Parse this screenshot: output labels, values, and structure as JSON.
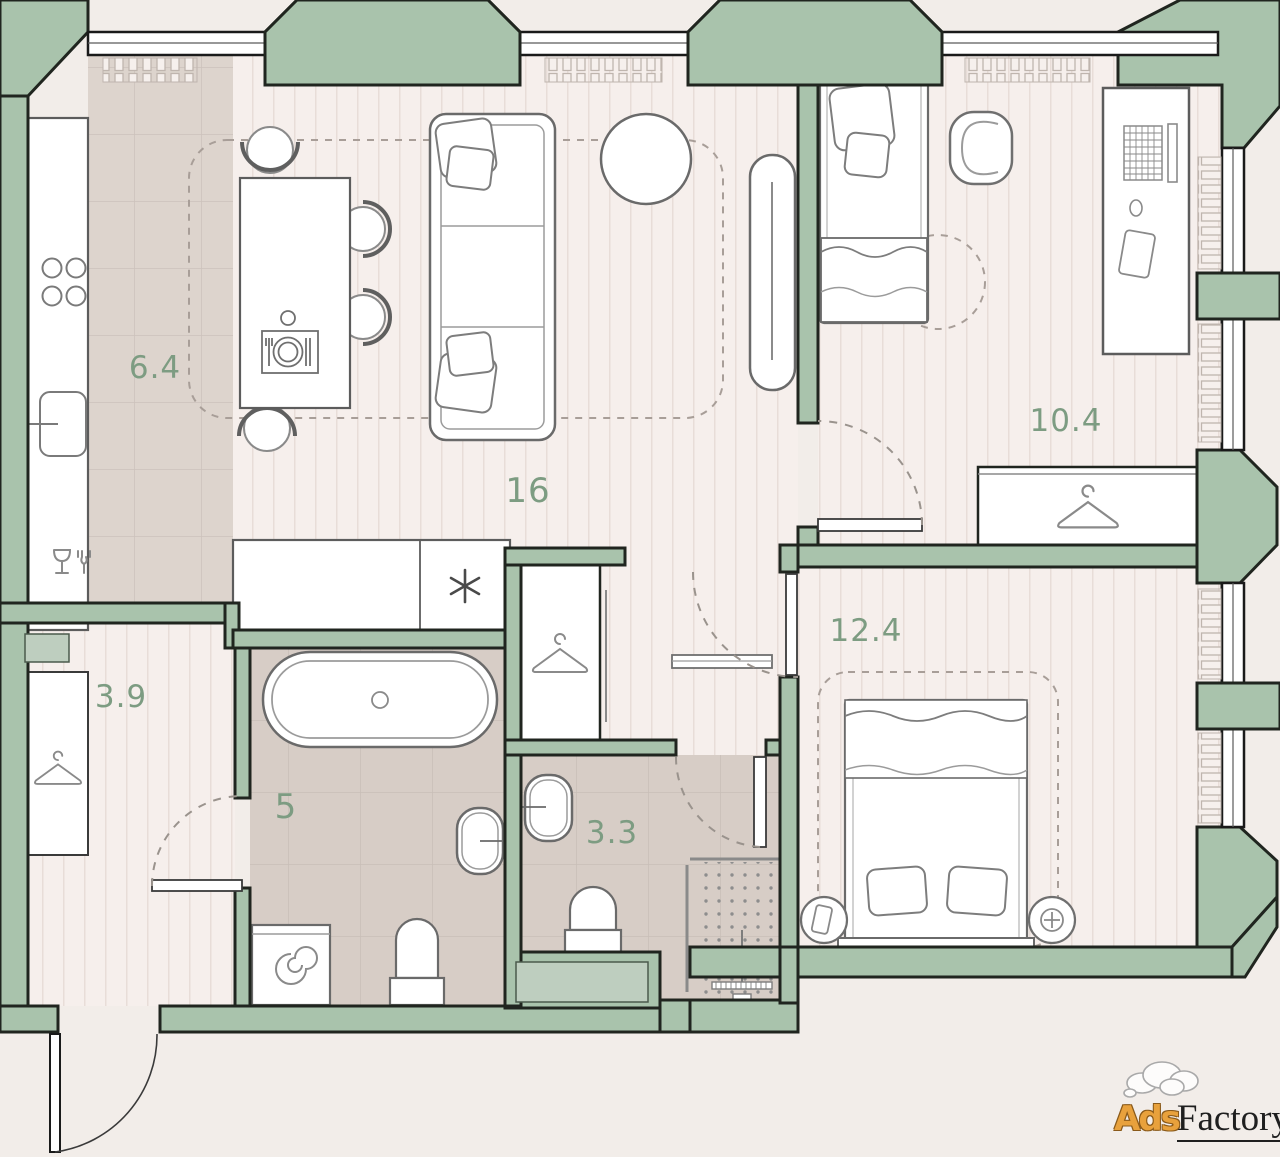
{
  "plan": {
    "type": "apartment-floor-plan",
    "rooms": [
      {
        "id": "kitchen",
        "area_label": "6.4"
      },
      {
        "id": "living-room",
        "area_label": "16"
      },
      {
        "id": "hallway",
        "area_label": "3.9"
      },
      {
        "id": "bathroom",
        "area_label": "5"
      },
      {
        "id": "shower-room",
        "area_label": "3.3"
      },
      {
        "id": "bedroom",
        "area_label": "10.4"
      },
      {
        "id": "master-bedroom",
        "area_label": "12.4"
      }
    ],
    "colors": {
      "wall_green": "#a9c3ac",
      "wall_outline": "#20251f",
      "floor_wood": "#f6efec",
      "floor_tile_kitchen": "#ddd4cd",
      "floor_tile_bath": "#d7cdc6",
      "label_green": "#7d9c82",
      "furniture_outline": "#6f6f6f",
      "niche_green": "#becebf"
    }
  },
  "watermark": {
    "ads": "Ads",
    "factory": "Factory"
  }
}
